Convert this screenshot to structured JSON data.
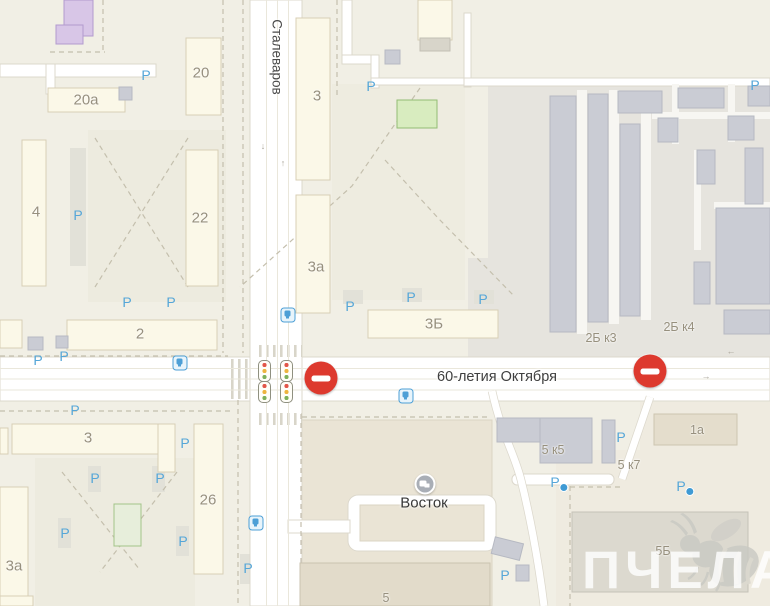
{
  "map": {
    "streets": {
      "stalevarov": "Сталеваров",
      "oktyabrya": "60-летия Октября"
    },
    "poi": {
      "vostok": "Восток"
    },
    "watermark": "ПЧЕЛА",
    "parking_letter": "P",
    "building_labels": [
      "20",
      "20а",
      "4",
      "22",
      "2",
      "3",
      "3а",
      "3Б",
      "2Б к3",
      "2Б к4",
      "3",
      "26",
      "3а",
      "5 к5",
      "5 к7",
      "1а",
      "5Б",
      "5"
    ],
    "road_arrows": [
      "↓",
      "↑",
      "→",
      "←"
    ],
    "signs": {
      "no_entry_count": 2,
      "traffic_light_count": 4
    },
    "colors": {
      "background": "#f1efe5",
      "road": "#ffffff",
      "residential_building": "#fbf8e8",
      "industrial_building": "#caccd4",
      "industrial_zone": "#e6e4de",
      "parking_blue": "#55a6d8",
      "no_entry_red": "#dd392e",
      "school_purple": "#d8c6e7",
      "green_area": "#d8ecbf",
      "street_label": "#3f3f3f",
      "building_label": "#97907e",
      "watermark": "rgba(255,255,255,0.8)"
    }
  }
}
